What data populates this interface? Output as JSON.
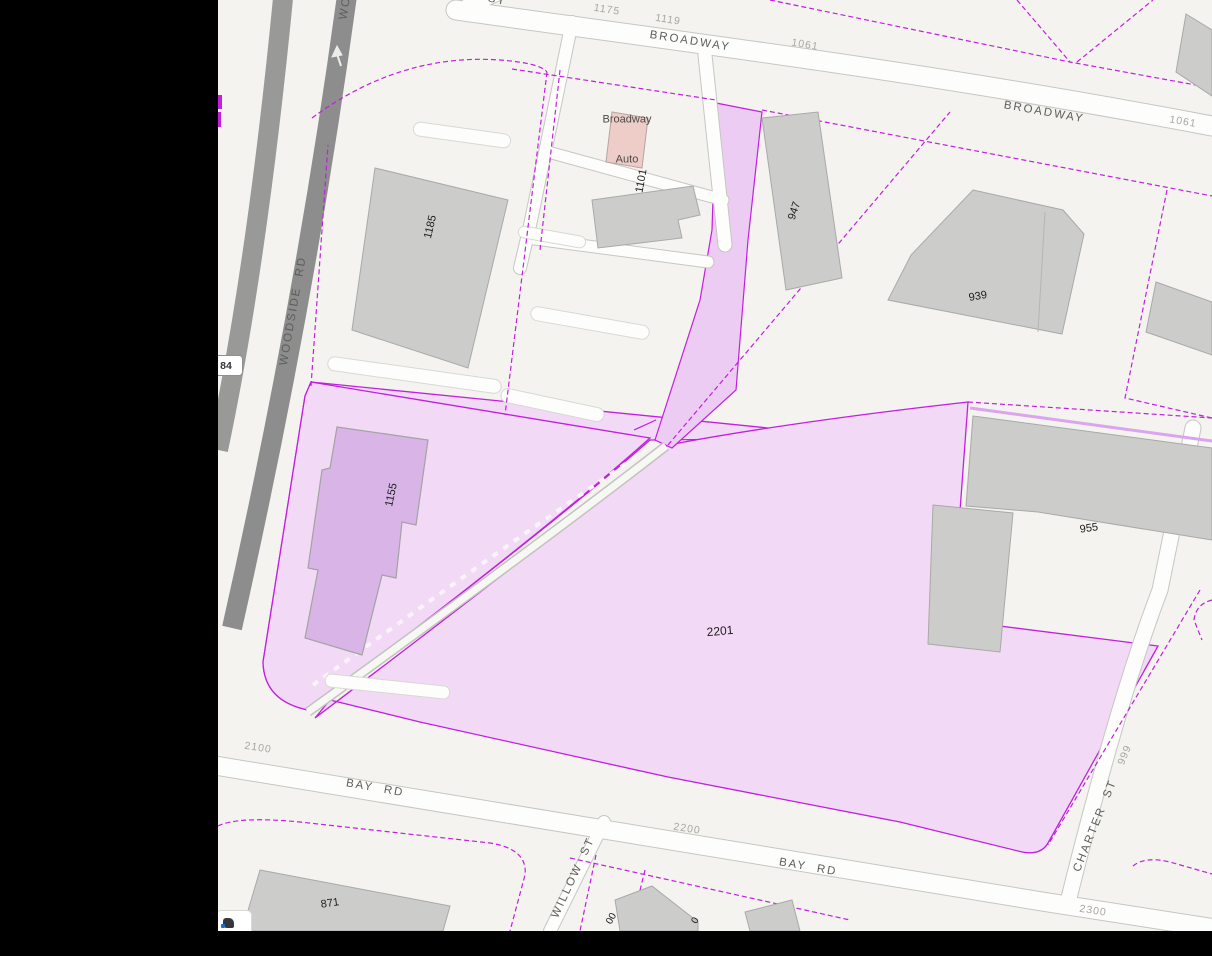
{
  "colors": {
    "frame": "#000000",
    "bg": "#f4f3ef",
    "road-fill": "#fdfdfb",
    "road-casing": "#c6c6c2",
    "hwy": "#8d8d8d",
    "hwy2": "#999997",
    "bld": "#cccccb",
    "bld-stroke": "#a9a9a7",
    "pink": "#f2daf7",
    "pink2": "#edccf3",
    "magenta": "#c21fe0",
    "magenta-light": "#dba4ef",
    "mauve": "#d9b4e6",
    "poi": "#eeccc8",
    "poi-stroke": "#b7a49e",
    "lbl-dark": "#1d1d1b",
    "lbl-street": "#5d5d5a",
    "lbl-faint": "#a9a7a2",
    "lbl-poi": "#4a4a46"
  },
  "labels": {
    "streets": [
      {
        "text": "BROADWAY"
      },
      {
        "text": "BROADWAY"
      },
      {
        "text": "WOODSIDE  RD"
      },
      {
        "text": "WO"
      },
      {
        "text": "BAY  RD"
      },
      {
        "text": "BAY  RD"
      },
      {
        "text": "WILLOW  ST"
      },
      {
        "text": "CHARTER  ST"
      },
      {
        "text": "ST"
      }
    ],
    "numbers": [
      {
        "text": "1175"
      },
      {
        "text": "1119"
      },
      {
        "text": "1061"
      },
      {
        "text": "1061"
      },
      {
        "text": "1101"
      },
      {
        "text": "947"
      },
      {
        "text": "1185"
      },
      {
        "text": "939"
      },
      {
        "text": "955"
      },
      {
        "text": "1155"
      },
      {
        "text": "2201"
      },
      {
        "text": "871"
      },
      {
        "text": "2100"
      },
      {
        "text": "2200"
      },
      {
        "text": "2300"
      },
      {
        "text": "999"
      },
      {
        "text": "00"
      },
      {
        "text": "0"
      }
    ],
    "poi": {
      "line1": "Broadway",
      "line2": "Auto"
    },
    "shield": {
      "text": "84"
    }
  }
}
